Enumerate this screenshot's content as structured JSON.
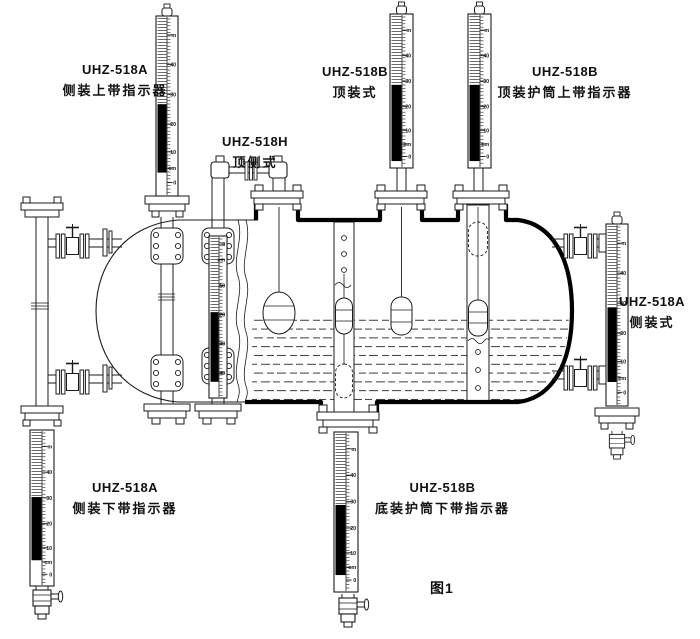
{
  "figure": {
    "caption": "图1"
  },
  "colors": {
    "ink": "#1b1b1b",
    "background": "#ffffff",
    "indicator_fill": "#000000"
  },
  "labels": [
    {
      "model": "UHZ-518A",
      "name": "侧装上带指示器"
    },
    {
      "model": "UHZ-518B",
      "name": "顶装式"
    },
    {
      "model": "UHZ-518B",
      "name": "顶装护筒上带指示器"
    },
    {
      "model": "UHZ-518H",
      "name": "顶侧式"
    },
    {
      "model": "UHZ-518A",
      "name": "侧装式"
    },
    {
      "model": "UHZ-518A",
      "name": "侧装下带指示器"
    },
    {
      "model": "UHZ-518B",
      "name": "底装护筒下带指示器"
    }
  ],
  "gauge_scales": {
    "standard": [
      "m",
      "40",
      "30",
      "20",
      "10",
      "cm",
      "0"
    ],
    "top_down": [
      "0",
      "cm",
      "10",
      "20",
      "30",
      "40"
    ]
  }
}
